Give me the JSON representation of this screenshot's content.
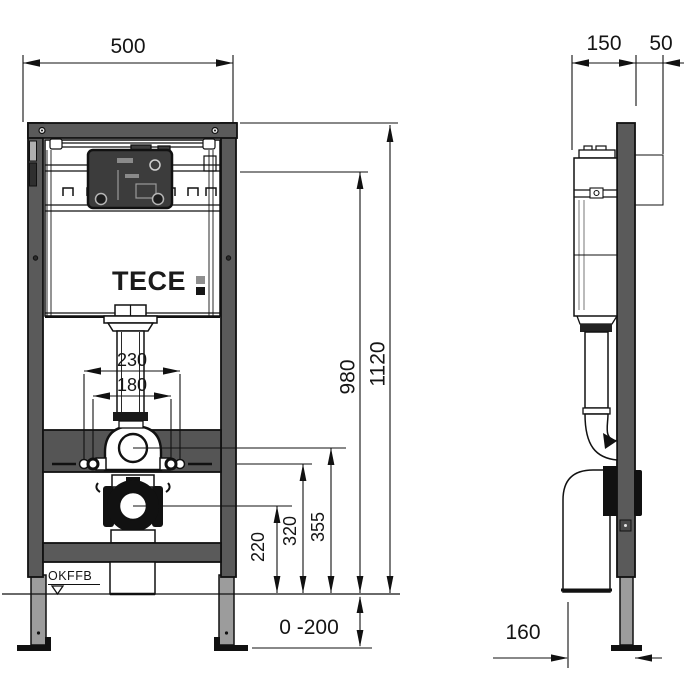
{
  "drawing": {
    "title": "TECE WC installation module - dimensioned drawing, front and side view",
    "brand": {
      "logo_text": "TECE",
      "colon_top_color": "#8f8f8f",
      "colon_bottom_color": "#151515"
    },
    "front_view": {
      "dimensions": {
        "overall_width": "500",
        "overall_height": "1120",
        "cistern_top_height": "980",
        "outer_fixing_width": "230",
        "inner_fixing_width": "180",
        "flush_bend_height": "355",
        "fixing_height": "320",
        "drain_height": "220",
        "leg_adjustment": "0 -200"
      },
      "floor_label": "OKFFB"
    },
    "side_view": {
      "dimensions": {
        "frame_depth": "150",
        "front_clearance": "50",
        "drain_offset": "160"
      }
    },
    "colors": {
      "frame": "#5a5a5a",
      "leg": "#9c9c9c",
      "line": "#111111",
      "background": "#ffffff"
    }
  }
}
